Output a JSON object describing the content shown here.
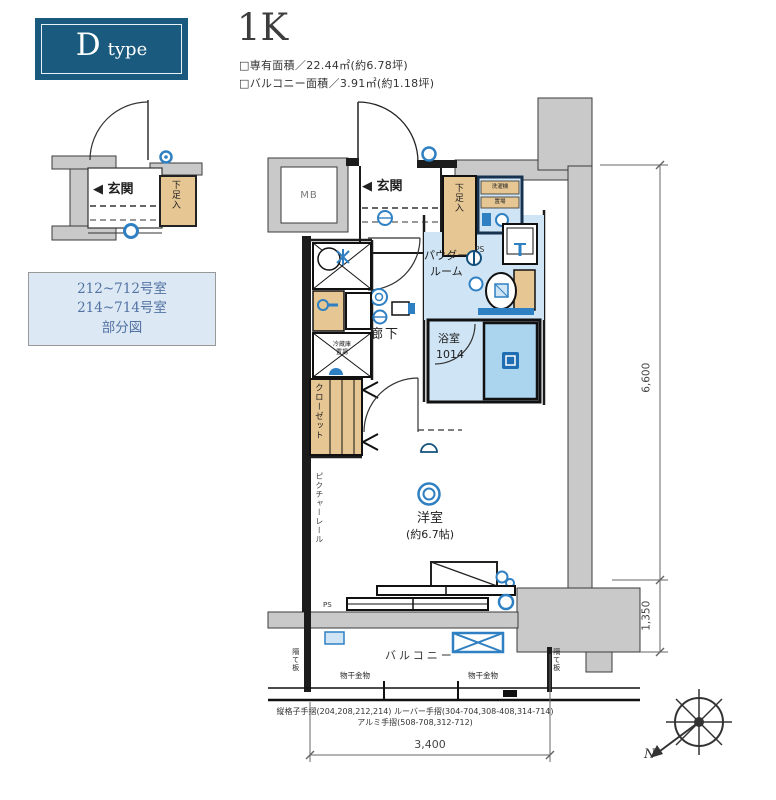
{
  "header": {
    "type_letter": "D",
    "type_word": "type",
    "layout_label": "1K",
    "area_line1": "□専有面積／22.44㎡(約6.78坪)",
    "area_line2": "□バルコニー面積／3.91㎡(約1.18坪)"
  },
  "partial_plan": {
    "entrance": "◀ 玄関",
    "shoe_box": "下足入"
  },
  "note_box": {
    "line1": "212~712号室",
    "line2": "214~714号室",
    "line3": "部分図"
  },
  "plan": {
    "mb": "MB",
    "entrance": "◀ 玄関",
    "shoe_box": "下足入",
    "washer_line1": "洗濯機",
    "washer_line2": "置場",
    "ps_top": "PS",
    "powder_line1": "パウダー",
    "powder_line2": "ルーム",
    "bath_line1": "浴室",
    "bath_line2": "1014",
    "corridor": "廊下",
    "fridge_line1": "冷蔵庫",
    "fridge_line2": "置場",
    "closet": "クローゼット",
    "picture_rail": "ピクチャーレール",
    "room_line1": "洋室",
    "room_line2": "(約6.7帖)",
    "ps_bottom": "PS",
    "balcony": "バルコニー",
    "laundry_left": "物干金物",
    "laundry_right": "物干金物",
    "partition_left": "隔て板",
    "partition_right": "隔て板"
  },
  "dimensions": {
    "right_main": "6,600",
    "right_balcony": "1,350",
    "bottom": "3,400"
  },
  "notes": {
    "line1": "縦格子手摺(204,208,212,214) ルーバー手摺(304-704,308-408,314-714)",
    "line2": "アルミ手摺(508-708,312-712)"
  },
  "compass": {
    "north": "N"
  },
  "colors": {
    "type_box": "#1a5a7e",
    "note_box_bg": "#dce8f3",
    "note_text": "#52709e",
    "floor_blue": "#cfe4f4",
    "tub_blue": "#abd4ee",
    "accent_blue": "#2f80c3",
    "wood_tan": "#e6c693",
    "concrete_gray": "#c9c9c9",
    "wall_black": "#1c1c1c"
  }
}
